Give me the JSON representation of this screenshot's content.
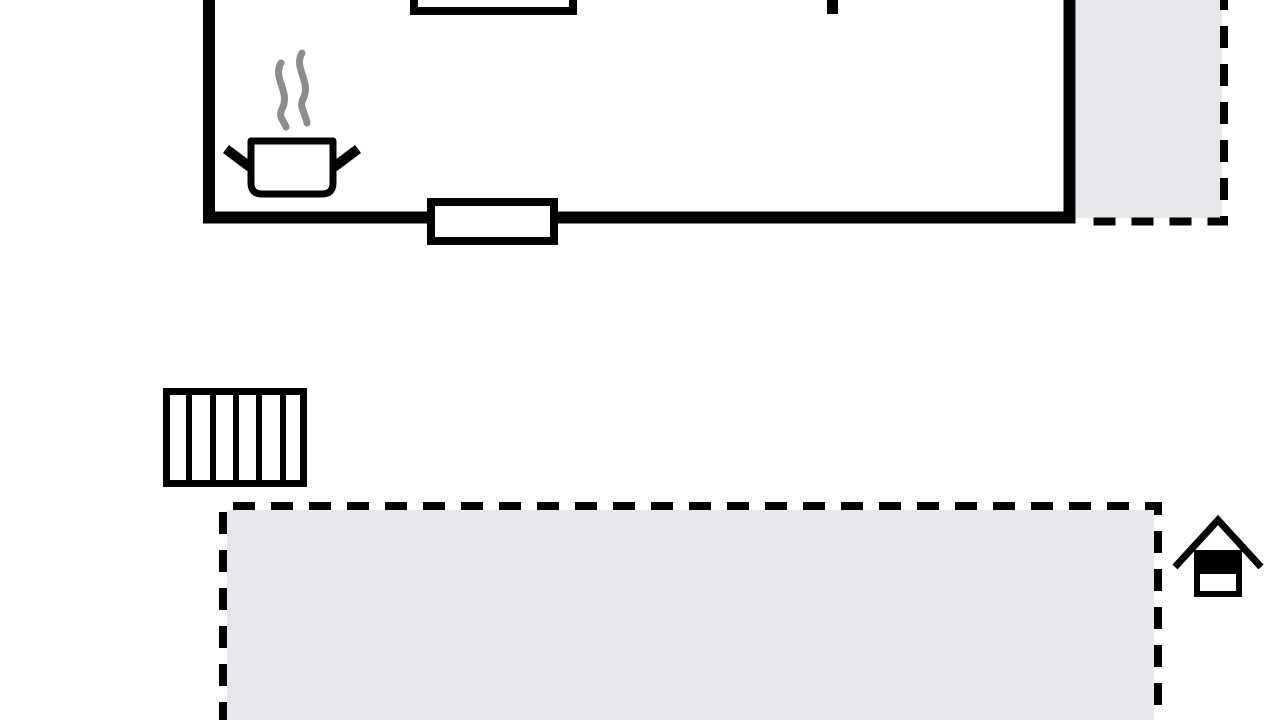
{
  "canvas": {
    "width": 1280,
    "height": 720,
    "background": "#ffffff"
  },
  "colors": {
    "wall": "#000000",
    "area_fill": "#e8e8ec",
    "steam": "#8c8c8c",
    "white": "#ffffff"
  },
  "elements": [
    {
      "name": "terrace-upper-fill",
      "tag": "rect",
      "attrs": {
        "x": 1076,
        "y": -8,
        "width": 146,
        "height": 226,
        "fill": "@area_fill"
      }
    },
    {
      "name": "terrace-upper-dashed-border",
      "tag": "path",
      "attrs": {
        "d": "M1224 -12 L1224 221.5 L1078 221.5",
        "fill": "none",
        "stroke": "@wall",
        "stroke-width": 8,
        "stroke-dasharray": "22 16"
      }
    },
    {
      "name": "kitchen-walls",
      "tag": "path",
      "attrs": {
        "d": "M209 -20 L209 217.5 L1069.5 217.5 L1069.5 -20",
        "fill": "none",
        "stroke": "@wall",
        "stroke-width": 12,
        "stroke-miterlimit": 10
      }
    },
    {
      "name": "window-top-icon",
      "tag": "rect",
      "attrs": {
        "x": 414,
        "y": -40,
        "width": 159,
        "height": 51,
        "fill": "@white",
        "stroke": "@wall",
        "stroke-width": 8
      }
    },
    {
      "name": "interior-wall-stub",
      "tag": "rect",
      "attrs": {
        "x": 827,
        "y": 0,
        "width": 11,
        "height": 14,
        "fill": "@wall"
      }
    },
    {
      "name": "window-bottom-icon",
      "tag": "rect",
      "attrs": {
        "x": 431,
        "y": 202,
        "width": 123,
        "height": 39,
        "fill": "@white",
        "stroke": "@wall",
        "stroke-width": 8
      }
    },
    {
      "name": "steam-left-icon",
      "tag": "path",
      "attrs": {
        "d": "M281 63 C272 78 291 92 282 109 C278 117 284 121 286 127",
        "fill": "none",
        "stroke": "@steam",
        "stroke-width": 7,
        "stroke-linecap": "round"
      }
    },
    {
      "name": "steam-right-icon",
      "tag": "path",
      "attrs": {
        "d": "M302 53 C293 68 312 82 303 99 C299 107 305 112 307 123",
        "fill": "none",
        "stroke": "@steam",
        "stroke-width": 7,
        "stroke-linecap": "round"
      }
    },
    {
      "name": "pot-handle-left-icon",
      "tag": "line",
      "attrs": {
        "x1": 226,
        "y1": 149,
        "x2": 250,
        "y2": 167,
        "stroke": "@wall",
        "stroke-width": 10
      }
    },
    {
      "name": "pot-handle-right-icon",
      "tag": "line",
      "attrs": {
        "x1": 334,
        "y1": 167,
        "x2": 358,
        "y2": 149,
        "stroke": "@wall",
        "stroke-width": 10
      }
    },
    {
      "name": "cooking-pot-icon",
      "tag": "path",
      "attrs": {
        "d": "M251 141 L333 141 L333 183 Q333 194 322 194 L262 194 Q251 194 251 183 Z",
        "fill": "@white",
        "stroke": "@wall",
        "stroke-width": 7,
        "stroke-linejoin": "round"
      }
    },
    {
      "name": "stairs-icon-frame",
      "tag": "rect",
      "attrs": {
        "x": 166.5,
        "y": 391.5,
        "width": 137,
        "height": 92,
        "fill": "@white",
        "stroke": "@wall",
        "stroke-width": 7
      }
    },
    {
      "name": "stairs-tread-line-1",
      "tag": "line",
      "attrs": {
        "x1": 189,
        "y1": 391,
        "x2": 189,
        "y2": 484,
        "stroke": "@wall",
        "stroke-width": 6
      }
    },
    {
      "name": "stairs-tread-line-2",
      "tag": "line",
      "attrs": {
        "x1": 213,
        "y1": 391,
        "x2": 213,
        "y2": 484,
        "stroke": "@wall",
        "stroke-width": 6
      }
    },
    {
      "name": "stairs-tread-line-3",
      "tag": "line",
      "attrs": {
        "x1": 236,
        "y1": 391,
        "x2": 236,
        "y2": 484,
        "stroke": "@wall",
        "stroke-width": 6
      }
    },
    {
      "name": "stairs-tread-line-4",
      "tag": "line",
      "attrs": {
        "x1": 259,
        "y1": 391,
        "x2": 259,
        "y2": 484,
        "stroke": "@wall",
        "stroke-width": 6
      }
    },
    {
      "name": "stairs-tread-line-5",
      "tag": "line",
      "attrs": {
        "x1": 283,
        "y1": 391,
        "x2": 283,
        "y2": 484,
        "stroke": "@wall",
        "stroke-width": 6
      }
    },
    {
      "name": "terrace-lower-fill",
      "tag": "rect",
      "attrs": {
        "x": 227,
        "y": 510,
        "width": 927,
        "height": 212,
        "fill": "@area_fill"
      }
    },
    {
      "name": "terrace-lower-dashed-border",
      "tag": "path",
      "attrs": {
        "d": "M223 724 L223 506 L1158 506 L1158 724",
        "fill": "none",
        "stroke": "@wall",
        "stroke-width": 8,
        "stroke-dasharray": "22 16"
      }
    },
    {
      "name": "house-roof-icon",
      "tag": "path",
      "attrs": {
        "d": "M1175 567 L1218 520 L1261 567",
        "fill": "none",
        "stroke": "@wall",
        "stroke-width": 7,
        "stroke-miterlimit": 10
      }
    },
    {
      "name": "house-body-icon",
      "tag": "rect",
      "attrs": {
        "x": 1197,
        "y": 553,
        "width": 42,
        "height": 41,
        "fill": "@white",
        "stroke": "@wall",
        "stroke-width": 6
      }
    },
    {
      "name": "house-body-top-fill",
      "tag": "rect",
      "attrs": {
        "x": 1194,
        "y": 550,
        "width": 48,
        "height": 24,
        "fill": "@wall"
      }
    }
  ]
}
